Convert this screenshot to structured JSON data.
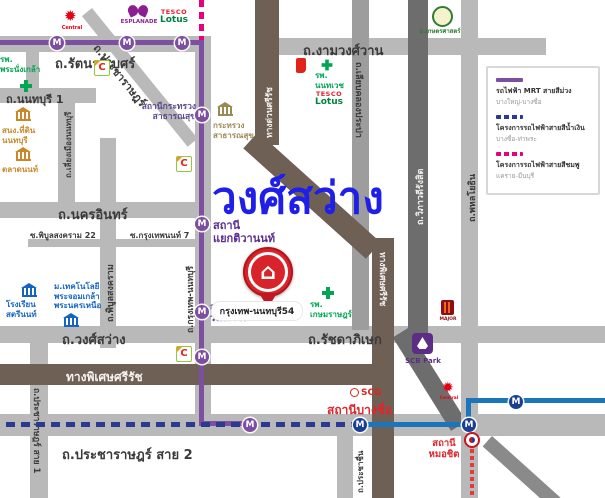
{
  "title": "วงศ์สว่าง",
  "marker": {
    "label": "M"
  },
  "pin": {
    "label": "กรุงเทพ-นนทบุรี54"
  },
  "colors": {
    "mrt_purple": "#7d4fa0",
    "blue_line_project": "#2b3990",
    "blue_line_solid": "#1b75bb",
    "pink_line_project": "#e6007e",
    "red_line": "#e23b3b",
    "expressway_brown": "#6f6056",
    "road_gray": "#b9b9b9",
    "road_dark_gray": "#6d6d6d",
    "title_blue": "#1f1fe8",
    "station_purple": "#5c2d91",
    "station_red": "#e0252b",
    "hospital_green": "#00a651",
    "landmark_blue": "#1565c0"
  },
  "roads": {
    "rattanathibet": "ถ.รัตนาธิเบศร์",
    "ngamwongwan": "ถ.งามวงศ์วาน",
    "nonthaburi1": "ถ.นนทบุรี 1",
    "nakhon_in": "ถ.นครอินทร์",
    "soi_phibun22": "ซ.พิบูลสงคราม 22",
    "soi_krungthepnon7": "ซ.กรุงเทพนนท์ 7",
    "wong_sawang": "ถ.วงศ์สว่าง",
    "ratchadaphisek": "ถ.รัชดาภิเษก",
    "pracharat_sai2": "ถ.ประชาราษฎร์ สาย 2",
    "pracharat_sai1": "ถ.ประชาราษฎร์ สาย 1",
    "pracharat": "ถ.ประชาราษฎร์",
    "phibunsongkhram": "ถ.พิบูลสงคราม",
    "liang_mueang_nonthaburi": "ถ.เลี่ยงเมืองนนทบุรี",
    "krungthep_nonthaburi": "ถ.กรุงเทพ-นนทบุรี",
    "liab_khlong_prapa": "ถ.เลียบคลองประปา",
    "vibhavadi_rangsit": "ถ.วิภาวดีรังสิต",
    "phahonyothin": "ถ.พหลโยธิน",
    "prachachuen": "ถ.ประชาชื่น",
    "srirat_expressway": "ทางพิเศษศรีรัช",
    "srirat_expressway_v": "ทางพิเศษศรีรัช",
    "expressway_north": "ทางด่วนศรีรัช"
  },
  "stations": {
    "health_ministry": "สถานีกระทรวง\nสาธารณสุข",
    "yaek_tiwanon": "สถานี\nแยกติวานนท์",
    "wong_sawang": "สถานี\nวงศ์สว่าง",
    "bang_sue": "สถานีบางซื่อ",
    "mo_chit": "สถานี\nหมอชิต"
  },
  "landmarks": {
    "central_1": "Central",
    "central_2": "Central",
    "esplanade": "ESPLANADE",
    "tesco_top": "TESCO",
    "tesco_bottom": "Lotus",
    "big_c_letter": "C",
    "phra_nangklao_hospital": "รพ.\nพระนั่งเกล้า",
    "nonthaburi_land_office": "สนง.ที่ดิน\nนนทบุรี",
    "talad_non": "ตลาดนนท์",
    "health_ministry_building": "กระทรวง\nสาธารณสุข",
    "kasetsart_university": "ม.เกษตรศาสตร์",
    "nonthavej_hospital": "รพ.\nนนทเวช",
    "satri_non_school": "โรงเรียน\nสตรีนนท์",
    "kmutnb": "ม.เทคโนโลยี\nพระจอมเกล้า\nพระนครเหนือ",
    "kasemrad_hospital": "รพ.\nเกษมราษฎร์",
    "scg": "SCG",
    "major_cineplex": "MAJOR",
    "scb_park": "SCB Park"
  },
  "legend": {
    "items": [
      {
        "title": "รถไฟฟ้า MRT สายสีม่วง",
        "subtitle": "บางใหญ่-บางซื่อ",
        "style": "solid",
        "color": "#7d4fa0"
      },
      {
        "title": "โครงการรถไฟฟ้าสายสีน้ำเงิน",
        "subtitle": "บางซื่อ-ท่าพระ",
        "style": "dashed",
        "color": "#2b3990"
      },
      {
        "title": "โครงการรถไฟฟ้าสายสีชมพู",
        "subtitle": "แคราย-มีนบุรี",
        "style": "dashed",
        "color": "#e6007e"
      }
    ]
  }
}
